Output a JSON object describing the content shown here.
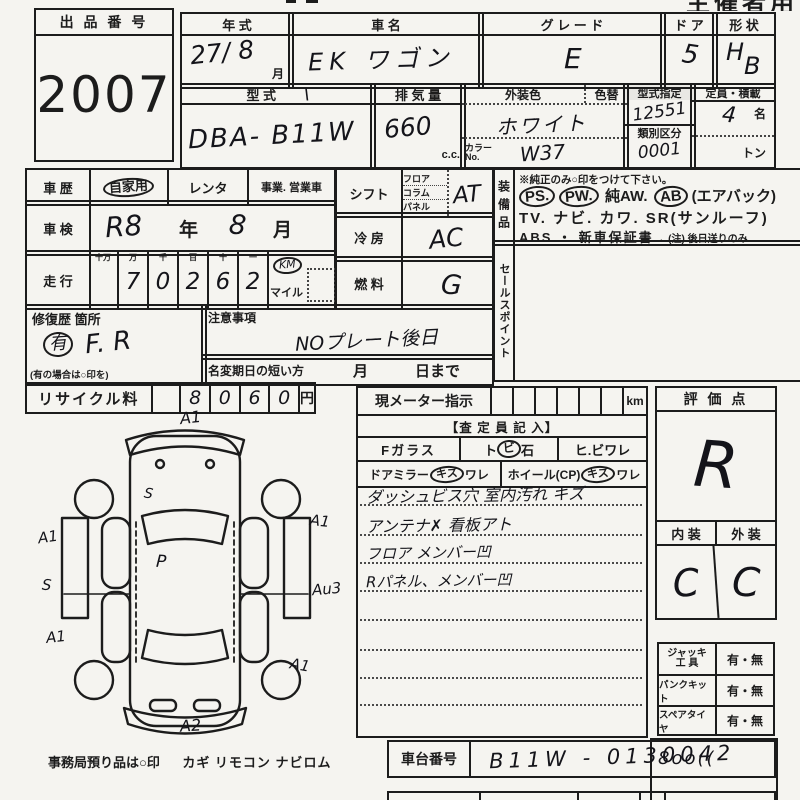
{
  "page": {
    "corner_label": "主催者用"
  },
  "auction": {
    "label": "出 品 番 号",
    "number": "2007"
  },
  "row1": {
    "year_label": "年  式",
    "year_value": "27/ 8",
    "year_month": "月",
    "name_label": "車  名",
    "name_value": "EK ワゴン",
    "grade_label": "グ レ ー ド",
    "grade_value": "E",
    "door_label": "ド ア",
    "door_value": "5",
    "shape_label": "形 状",
    "shape_h": "H",
    "shape_b": "B"
  },
  "row2": {
    "model_label": "型  式",
    "model_tick": "\\",
    "model_value": "DBA- B11W",
    "disp_label": "排 気 量",
    "disp_value": "660",
    "disp_unit": "c.c.",
    "color_label": "外装色",
    "colorchg_label": "色替",
    "color_value": "ホワイト",
    "colorno_label": "カラー",
    "colorno_label2": "No.",
    "colorno_value": "W37",
    "typedesig_label": "型式指定",
    "typedesig_value": "12551",
    "classdiv_label": "類別区分",
    "classdiv_value": "0001",
    "capacity_label": "定員・積載",
    "capacity_value": "4",
    "capacity_unit": "名",
    "load_unit": "トン"
  },
  "history": {
    "label": "車  歴",
    "opt1": "自家用",
    "opt2": "レンタ",
    "opt3": "事業. 営業車"
  },
  "inspection": {
    "label": "車  検",
    "value_era": "R8",
    "year": "年",
    "value_month": "8",
    "month": "月"
  },
  "mileage": {
    "label": "走  行",
    "headers": [
      "十万",
      "万",
      "千",
      "百",
      "十",
      "一"
    ],
    "digits": [
      "",
      "7",
      "0",
      "2",
      "6",
      "2"
    ],
    "km": "KM",
    "mile": "マイル"
  },
  "shift": {
    "label": "シフト",
    "opts": [
      "フロア",
      "コラム",
      "パネル"
    ],
    "value": "AT"
  },
  "aircon": {
    "label": "冷  房",
    "value": "AC"
  },
  "fuel": {
    "label": "燃  料",
    "value": "G"
  },
  "equipment": {
    "label": "装備品",
    "note": "※純正のみ○印をつけて下さい。",
    "l1": [
      {
        "t": "PS.",
        "c": true
      },
      {
        "t": "PW.",
        "c": true
      },
      {
        "t": "純AW.",
        "c": false
      },
      {
        "t": "AB",
        "c": true
      },
      {
        "t": "(エアバック)",
        "c": false
      }
    ],
    "l2": "TV.  ナビ.  カワ.  SR(サンルーフ)",
    "l3a": "ABS ・ 新車保証書",
    "l3b": "←(注) 後日送りのみ"
  },
  "sales": {
    "label": "セールスポイント"
  },
  "repair": {
    "label": "修復歴 箇所",
    "mark": "有",
    "value": "F. R",
    "note": "(有の場合は○印を)"
  },
  "caution": {
    "label": "注意事項",
    "value": "NOプレート後日"
  },
  "namechange": {
    "label": "名変期日の短い方",
    "month": "月",
    "day": "日まで"
  },
  "recycle": {
    "label": "リサイクル料",
    "digits": [
      "",
      "8",
      "0",
      "6",
      "0"
    ],
    "unit": "円"
  },
  "meter": {
    "label": "現メーター指示",
    "unit": "km"
  },
  "assessor": {
    "title": "【査 定 員 記 入】",
    "fglass": "Fガラス",
    "tobi_pre": "ト",
    "tobi_circ": "ビ",
    "tobi_post": "石",
    "hibi": "ヒ.ビワレ",
    "mirror": "ドアミラー",
    "mirror_circ": "キズ",
    "mirror_post": "ワレ",
    "wheel": "ホイール(CP)",
    "wheel_circ": "キズ",
    "wheel_post": "ワレ",
    "notes": [
      "ダッシュビス穴  室内汚れ  キズ",
      "アンテナ✗  看板アト",
      "フロア メンバー凹",
      "Rパネル、メンバー凹"
    ]
  },
  "evaluation": {
    "label": "評 価 点",
    "score": "R",
    "interior": "内 装",
    "exterior": "外 装",
    "int_grade": "C",
    "ext_grade": "C"
  },
  "accessories": [
    {
      "label": "ジャッキ",
      "label2": "工  具",
      "value": "有・無"
    },
    {
      "label": "パンクキット",
      "value": "有・無"
    },
    {
      "label": "スペアタイヤ",
      "value": "有・無"
    }
  ],
  "partial": {
    "value": "8oo(("
  },
  "chassis": {
    "label": "車台番号",
    "value": "B11W - 0130042"
  },
  "office": {
    "note": "事務局預り品は○印",
    "items": "カギ  リモコン  ナビロム"
  },
  "diagram": {
    "front": "A1",
    "hood": "S",
    "left_front": "A1",
    "left_mid": "S",
    "left_rear": "A1",
    "roof": "P",
    "right_front": "A1",
    "right_mid": "Au3",
    "right_rear": "A1",
    "rear": "A2"
  }
}
